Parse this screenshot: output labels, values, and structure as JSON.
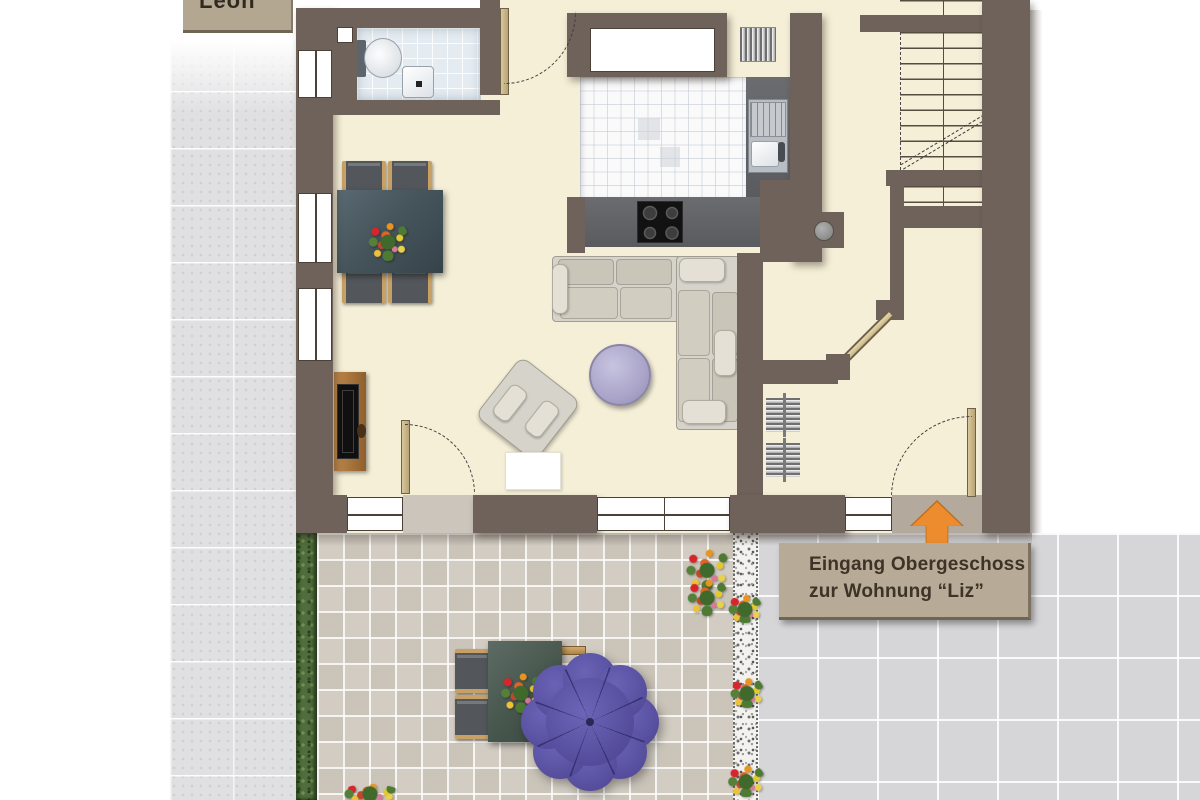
{
  "palette": {
    "wall": "#6e625a",
    "floor": "#f5efd8",
    "label-bg": "#b7aa96",
    "accent-orange": "#ec8c2f",
    "umbrella-purple": "#58509f",
    "terrace-tile": "#d2ccc2",
    "hedge-green": "#4f6d3d",
    "text-dark": "#3d3327"
  },
  "labels": {
    "unit_label": "Leon",
    "entrance_note_line1": "Eingang Obergeschoss",
    "entrance_note_line2": "zur Wohnung “Liz”"
  }
}
